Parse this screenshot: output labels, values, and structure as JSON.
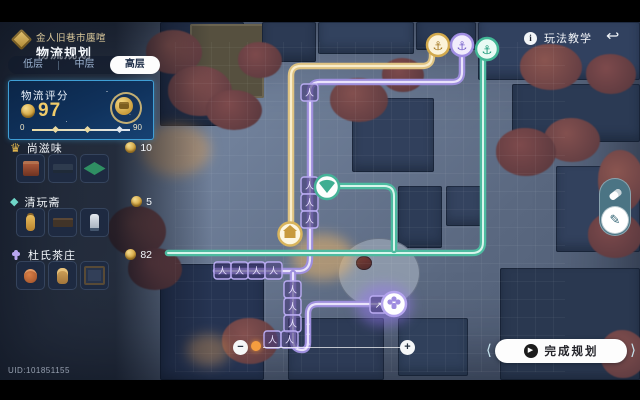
{
  "header": {
    "event_title": "金人旧巷市廛喧",
    "page_title": "物流规划"
  },
  "tabs": [
    {
      "label": "低层",
      "selected": false
    },
    {
      "label": "中层",
      "selected": false
    },
    {
      "label": "高层",
      "selected": true
    }
  ],
  "score_card": {
    "label": "物流评分",
    "value": "97",
    "min": "0",
    "max": "90"
  },
  "sections": [
    {
      "name": "尚滋味",
      "count": "10",
      "icon": "hat-icon",
      "items": [
        "red-crate",
        "wood-bench",
        "green-mat"
      ]
    },
    {
      "name": "清玩斋",
      "count": "5",
      "icon": "gem-icon",
      "items": [
        "gold-lantern",
        "dark-table",
        "white-statue"
      ]
    },
    {
      "name": "杜氏茶庄",
      "count": "82",
      "icon": "hand-icon",
      "items": [
        "orange-pot",
        "tall-urn",
        "cabinet"
      ]
    }
  ],
  "topbar": {
    "tutorial_label": "玩法教学"
  },
  "actions": {
    "finish_label": "完成规划"
  },
  "footer": {
    "uid": "UID:101851155"
  },
  "icons": {
    "anchor": "⚓",
    "person": "人",
    "diag_arrow": "↗",
    "chevron": "∧",
    "info": "i",
    "back": "↩",
    "play": "▶",
    "minus": "−",
    "plus": "+",
    "crown": "♛",
    "gem": "◆",
    "wing_l": "⟨",
    "wing_r": "⟩",
    "pen": "✎"
  },
  "colors": {
    "path_yellow": "#dfc382",
    "path_purple": "#9e8fdd",
    "path_green": "#4dbba0",
    "accent_blue": "#3f9fd6",
    "gold": "#e8c25c",
    "slider_dot_orange": "#f59d3f"
  }
}
